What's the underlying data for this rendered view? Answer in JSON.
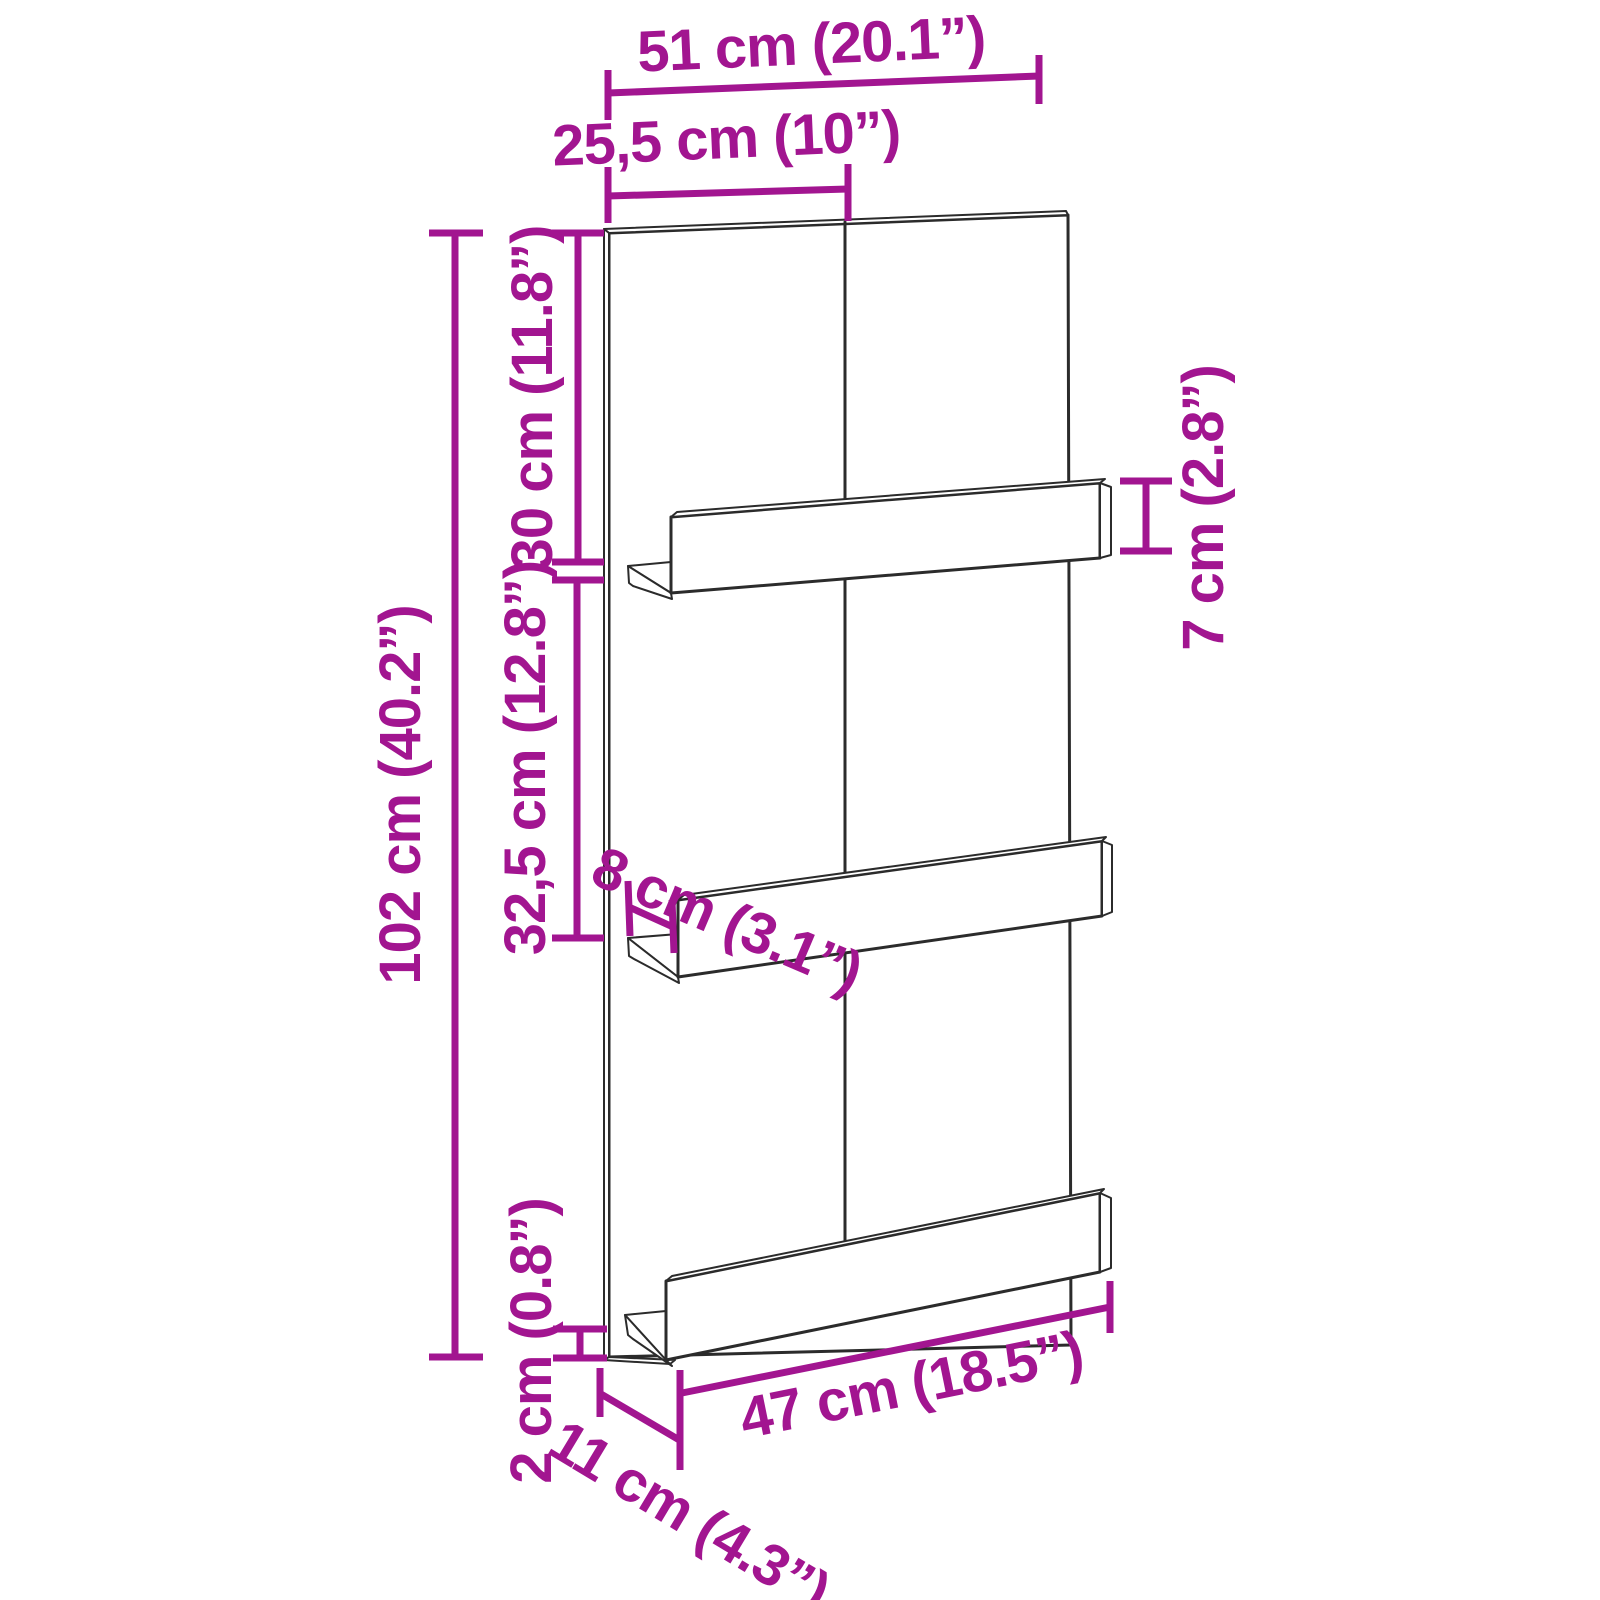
{
  "diagram": {
    "kind": "product dimension diagram",
    "item": "wall-mounted shelf panel with 3 ledge shelves",
    "colors": {
      "dimension_accent": "#A21590",
      "drawing_outline": "#2B2B2B",
      "background": "#FFFFFF"
    },
    "dimensions": {
      "width_total": {
        "cm": "51",
        "in": "20.1",
        "label": "51 cm (20.1”)"
      },
      "width_half": {
        "cm": "25,5",
        "in": "10",
        "label": "25,5 cm (10”)"
      },
      "top_section_height": {
        "cm": "30",
        "in": "11.8",
        "label": "30 cm (11.8”)"
      },
      "mid_section_height": {
        "cm": "32,5",
        "in": "12.8",
        "label": "32,5 cm (12.8”)"
      },
      "height_total": {
        "cm": "102",
        "in": "40.2",
        "label": "102 cm (40.2”)"
      },
      "rail_height": {
        "cm": "7",
        "in": "2.8",
        "label": "7 cm (2.8”)"
      },
      "shelf_depth": {
        "cm": "8",
        "in": "3.1",
        "label": "8 cm (3.1”)"
      },
      "panel_thickness": {
        "cm": "2",
        "in": "0.8",
        "label": "2 cm (0.8”)"
      },
      "base_depth": {
        "cm": "11",
        "in": "4.3",
        "label": "11 cm (4.3”)"
      },
      "shelf_length": {
        "cm": "47",
        "in": "18.5",
        "label": "47 cm (18.5”)"
      }
    }
  }
}
